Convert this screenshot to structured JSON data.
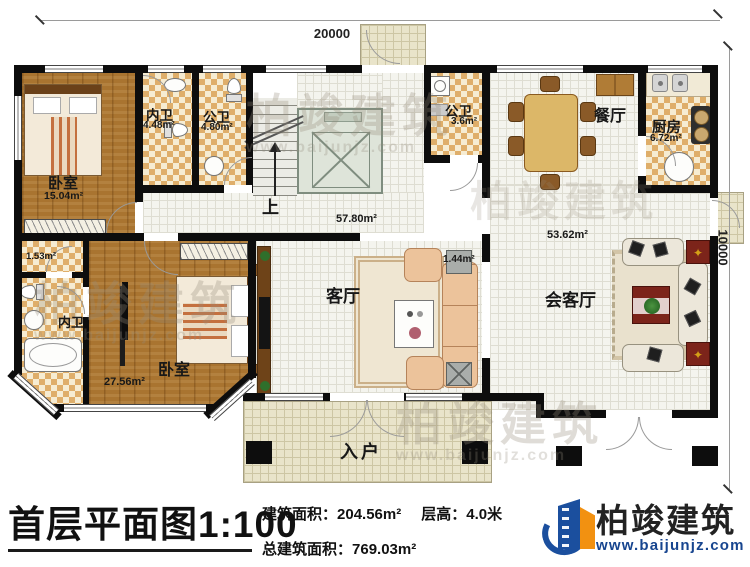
{
  "dimensions": {
    "width": "20000",
    "depth": "10000"
  },
  "rooms": {
    "bedroom_top": {
      "label": "卧室",
      "area": "15.04m²"
    },
    "bath_top": {
      "label": "内卫",
      "area": "4.48m²"
    },
    "bath_top2": {
      "label": "公卫",
      "area": "4.80m²"
    },
    "stairs": {
      "label": "上"
    },
    "living": {
      "label": "客厅",
      "area": "57.80m²"
    },
    "bath_mid": {
      "label": "公卫",
      "area": "3.6m²"
    },
    "dining": {
      "label": "餐厅"
    },
    "kitchen": {
      "label": "厨房",
      "area": "6.72m²"
    },
    "reception": {
      "label": "会客厅",
      "area": "53.62m²"
    },
    "shoe_cabinet": {
      "area": "1.44m²"
    },
    "bedroom_bottom": {
      "label": "卧室",
      "area": "27.56m²"
    },
    "bath_bottom": {
      "label": "内卫"
    },
    "storage": {
      "area": "1.53m²"
    },
    "entrance": {
      "label": "入户"
    }
  },
  "titleblock": {
    "title": "首层平面图1:100",
    "area_label": "建筑面积：",
    "area_value": "204.56m²",
    "height_label": "层高：",
    "height_value": "4.0米",
    "total_label": "总建筑面积：",
    "total_value": "769.03m²"
  },
  "brand": {
    "name": "柏竣建筑",
    "website": "www.baijunjz.com"
  },
  "watermark": {
    "text": "柏竣建筑",
    "url": "www.baijunjz.com"
  },
  "colors": {
    "wall": "#0d0d0d",
    "wood_floor": "#a97430",
    "tile_dark": "#dfae6a",
    "tile_light": "#f6ecd2",
    "logo_blue": "#1b4f9e",
    "logo_orange": "#f29111",
    "accent_red_table": "#7c241a"
  }
}
